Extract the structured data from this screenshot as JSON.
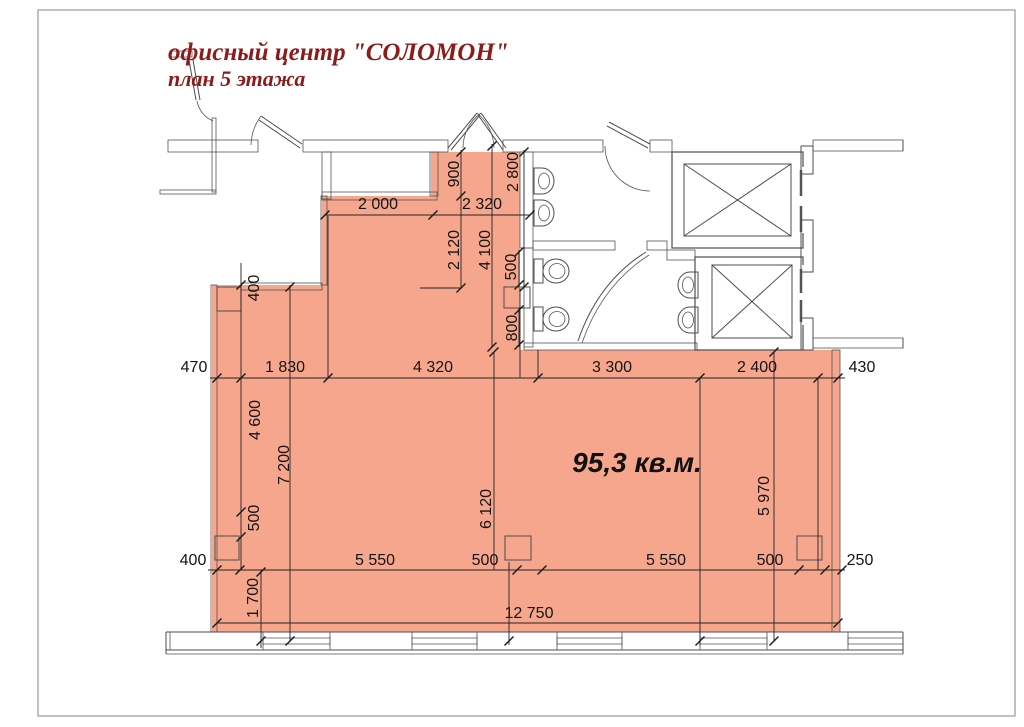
{
  "page": {
    "title_line1": "офисный центр \"СОЛОМОН\"",
    "title_line2": "план 5 этажа",
    "area_label": "95,3 кв.м."
  },
  "colors": {
    "room_fill": "#F5A68D",
    "title_color": "#8E1B1B",
    "plan_line": "#4D4D4D",
    "dim_text": "#141414"
  },
  "dims": {
    "top_2000": "2 000",
    "top_2320": "2 320",
    "v900": "900",
    "v2800": "2 800",
    "v2120": "2 120",
    "v4100": "4 100",
    "v500": "500",
    "v800": "800",
    "m470": "470",
    "m1830": "1 830",
    "m4320": "4 320",
    "m3300": "3 300",
    "m2400": "2 400",
    "m430": "430",
    "l400": "400",
    "l4600": "4 600",
    "l7200": "7 200",
    "l500": "500",
    "l1700": "1 700",
    "c6120": "6 120",
    "c5970": "5 970",
    "b400": "400",
    "b5550a": "5 550",
    "b500a": "500",
    "b5550b": "5 550",
    "b500b": "500",
    "b250": "250",
    "b12750": "12 750"
  }
}
